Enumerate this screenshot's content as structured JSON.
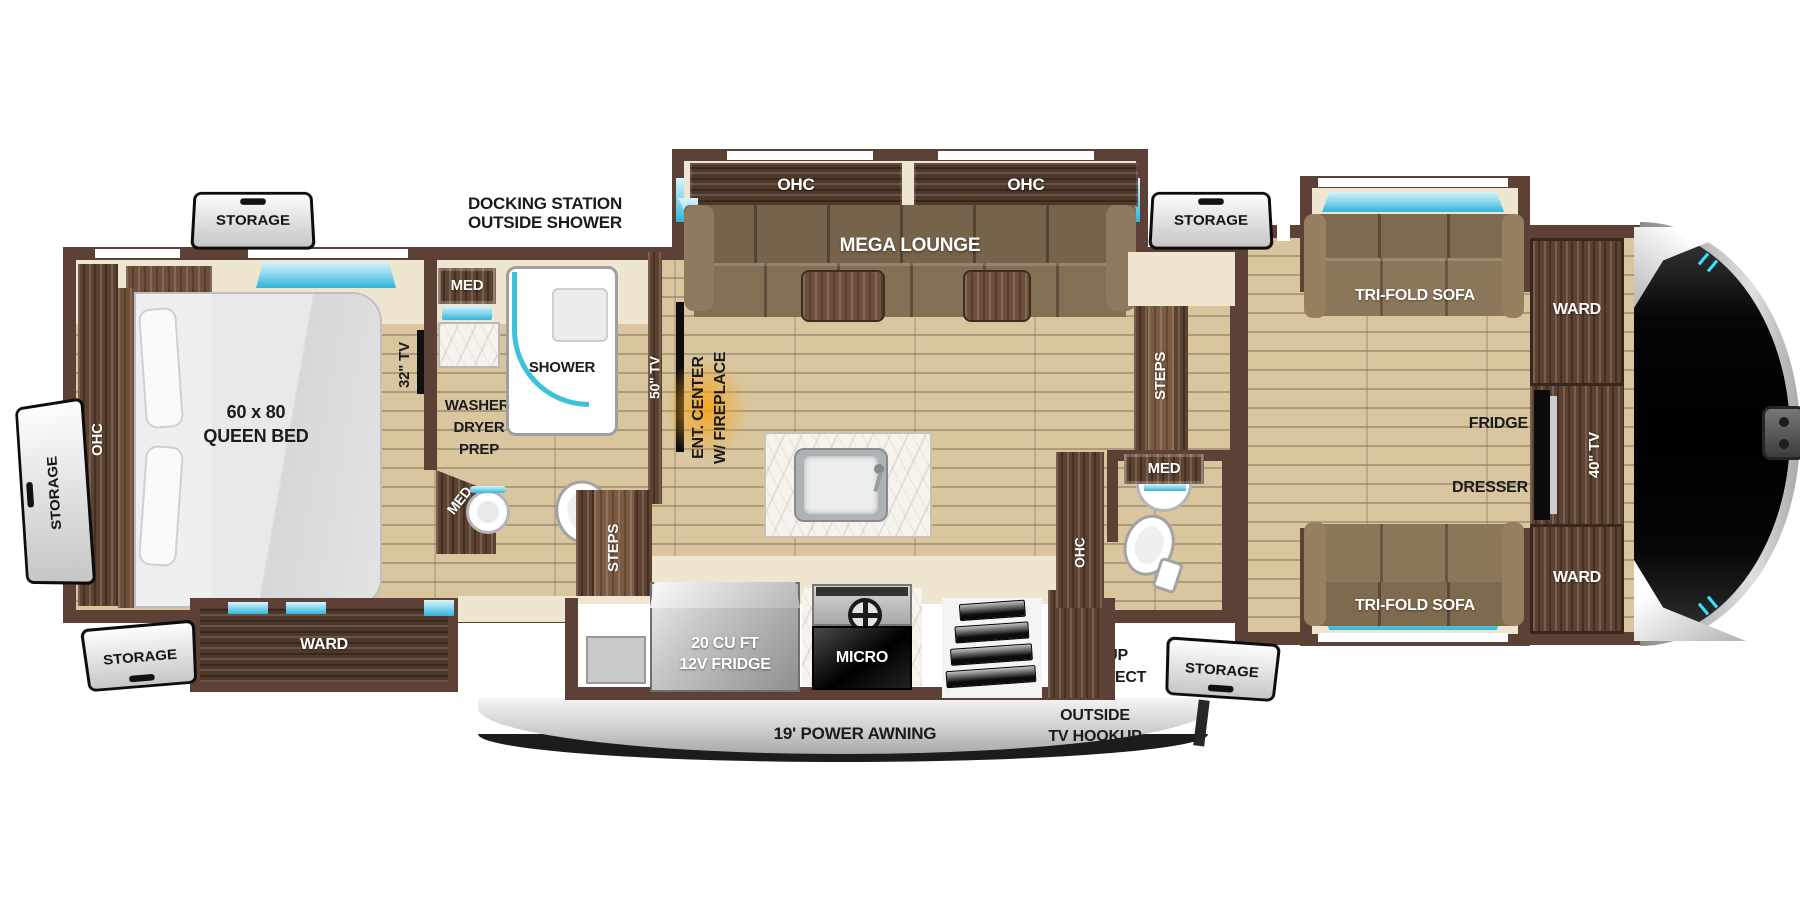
{
  "colors": {
    "wall_brown": "#5e4136",
    "floor_tan": "#d9c69f",
    "accent_teal": "#3ec1d9",
    "fireplace_glow": "#f5a51d",
    "awning_gray": "#d9d9d9"
  },
  "exterior": {
    "docking_note": [
      "DOCKING STATION",
      "OUTSIDE SHOWER"
    ],
    "awning_label": "19' POWER AWNING",
    "outside_tv": [
      "OUTSIDE",
      "TV HOOKUP"
    ],
    "grill": [
      "GRILL HOOKUP",
      "LP QUICK CONNECT"
    ],
    "storage": {
      "top_left": "STORAGE",
      "side_left": "STORAGE",
      "bottom_left": "STORAGE",
      "top_right": "STORAGE",
      "bottom_right": "STORAGE"
    }
  },
  "bedroom": {
    "ohc": "OHC",
    "bed": [
      "60 x 80",
      "QUEEN BED"
    ],
    "ward": "WARD",
    "tv": "32\" TV",
    "med_upper": "MED",
    "med_corner": "MED",
    "washer": [
      "WASHER/",
      "DRYER",
      "PREP"
    ],
    "shower": "SHOWER"
  },
  "living": {
    "ohc_left": "OHC",
    "ohc_right": "OHC",
    "sofa": "MEGA LOUNGE",
    "tv": "50\" TV",
    "ent_center": [
      "ENT. CENTER",
      "W/ FIREPLACE"
    ],
    "steps": "STEPS"
  },
  "kitchen": {
    "fridge": [
      "20 CU FT",
      "12V FRIDGE"
    ],
    "micro": "MICRO"
  },
  "half_bath": {
    "steps": "STEPS",
    "med": "MED",
    "ohc": "OHC"
  },
  "front_room": {
    "sofa_top": "TRI-FOLD SOFA",
    "sofa_bottom": "TRI-FOLD SOFA",
    "ward_top": "WARD",
    "ward_bottom": "WARD",
    "fridge": "FRIDGE",
    "tv": "40\" TV",
    "dresser": "DRESSER"
  }
}
